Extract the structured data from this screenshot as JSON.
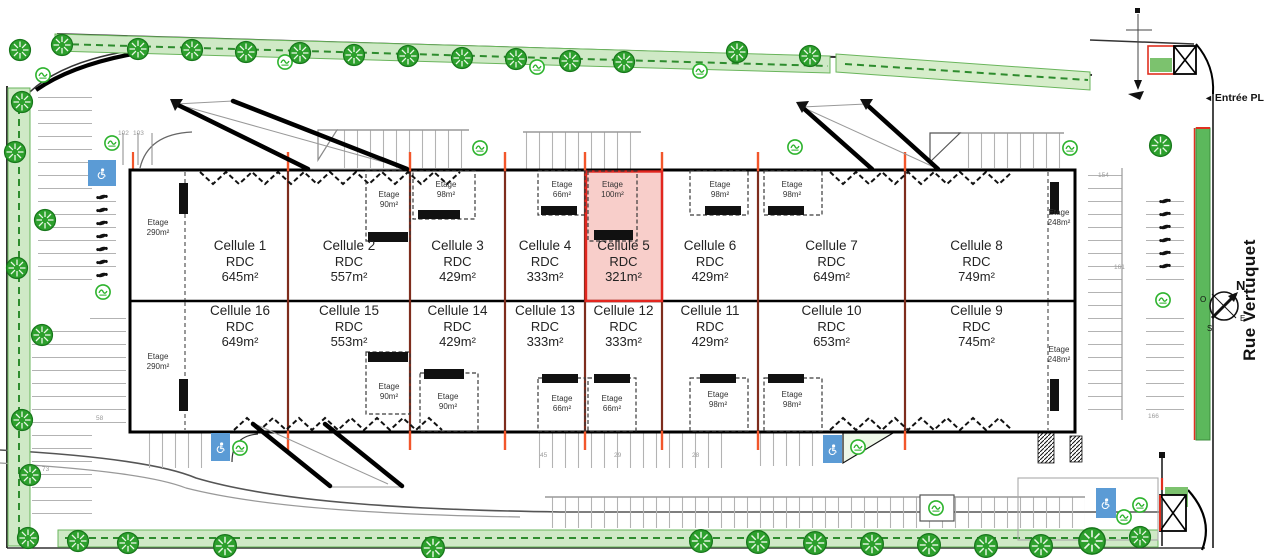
{
  "plan": {
    "street_name": "Rue Vertuquet",
    "entrance_label": "Entrée PL",
    "entrance_arrow": "◄",
    "compass": {
      "n": "N",
      "s": "S",
      "e": "E",
      "o": "O"
    },
    "colors": {
      "highlight_border": "#e2261f",
      "highlight_fill": "#ef8a80",
      "firewall": "#7e2d1d",
      "wall_tick": "#f2562b",
      "tree": "#2da02d",
      "hedge": "#cfe9c6",
      "disabled_parking": "#5b9bd5"
    }
  },
  "cells": [
    {
      "name": "Cellule 1",
      "floor": "RDC",
      "area": "645m²",
      "etage_label": "Etage",
      "etage_area": "290m²"
    },
    {
      "name": "Cellule 2",
      "floor": "RDC",
      "area": "557m²",
      "etage_label": "Etage",
      "etage_area": "90m²"
    },
    {
      "name": "Cellule 3",
      "floor": "RDC",
      "area": "429m²",
      "etage_label": "Etage",
      "etage_area": "98m²"
    },
    {
      "name": "Cellule 4",
      "floor": "RDC",
      "area": "333m²",
      "etage_label": "Etage",
      "etage_area": "66m²"
    },
    {
      "name": "Cellule 5",
      "floor": "RDC",
      "area": "321m²",
      "etage_label": "Etage",
      "etage_area": "100m²",
      "highlighted": true
    },
    {
      "name": "Cellule 6",
      "floor": "RDC",
      "area": "429m²",
      "etage_label": "Etage",
      "etage_area": "98m²"
    },
    {
      "name": "Cellule 7",
      "floor": "RDC",
      "area": "649m²",
      "etage_label": "Etage",
      "etage_area": "98m²"
    },
    {
      "name": "Cellule 8",
      "floor": "RDC",
      "area": "749m²",
      "etage_label": "Etage",
      "etage_area": "248m²"
    },
    {
      "name": "Cellule 16",
      "floor": "RDC",
      "area": "649m²",
      "etage_label": "Etage",
      "etage_area": "290m²"
    },
    {
      "name": "Cellule 15",
      "floor": "RDC",
      "area": "553m²",
      "etage_label": "Etage",
      "etage_area": "90m²"
    },
    {
      "name": "Cellule 14",
      "floor": "RDC",
      "area": "429m²",
      "etage_label": "Etage",
      "etage_area": "90m²"
    },
    {
      "name": "Cellule 13",
      "floor": "RDC",
      "area": "333m²",
      "etage_label": "Etage",
      "etage_area": "66m²"
    },
    {
      "name": "Cellule 12",
      "floor": "RDC",
      "area": "333m²",
      "etage_label": "Etage",
      "etage_area": "66m²"
    },
    {
      "name": "Cellule 11",
      "floor": "RDC",
      "area": "429m²",
      "etage_label": "Etage",
      "etage_area": "98m²"
    },
    {
      "name": "Cellule 10",
      "floor": "RDC",
      "area": "653m²",
      "etage_label": "Etage",
      "etage_area": "98m²"
    },
    {
      "name": "Cellule 9",
      "floor": "RDC",
      "area": "745m²",
      "etage_label": "Etage",
      "etage_area": "248m²"
    }
  ],
  "parking_numbers": [
    "102",
    "103",
    "154",
    "161",
    "58",
    "73",
    "45",
    "29",
    "28",
    "166"
  ]
}
